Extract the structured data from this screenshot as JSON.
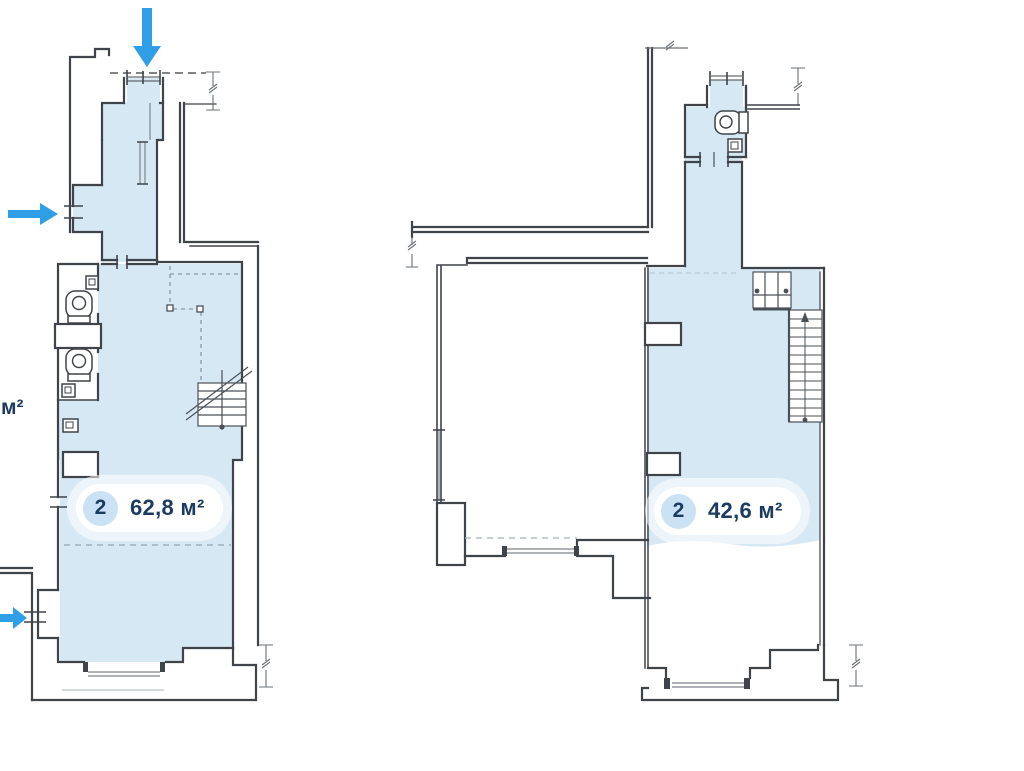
{
  "colors": {
    "background": "#ffffff",
    "unit_highlight": "#d7e8f5",
    "wall": "#3f444a",
    "thin_line": "#7d848c",
    "dashed_line": "#9fb0bd",
    "arrow": "#2f9fe8",
    "label_text": "#1b3c60",
    "badge_background": "#ffffff",
    "badge_circle": "#cbe2f5"
  },
  "units": [
    {
      "id": "unit-left",
      "rooms": "2",
      "area": "62,8 м²"
    },
    {
      "id": "unit-right",
      "rooms": "2",
      "area": "42,6 м²"
    }
  ],
  "edge_label": {
    "area": "м²"
  },
  "icons": {
    "entrances": [
      "entrance-arrow-down",
      "entrance-arrow-right-upper",
      "entrance-arrow-right-lower"
    ],
    "fixtures": [
      "toilet-icon",
      "toilet-icon",
      "toilet-icon",
      "sink-icon",
      "sink-icon",
      "sink-icon"
    ],
    "stairs": [
      "staircase-left-plan",
      "staircase-right-plan"
    ]
  }
}
